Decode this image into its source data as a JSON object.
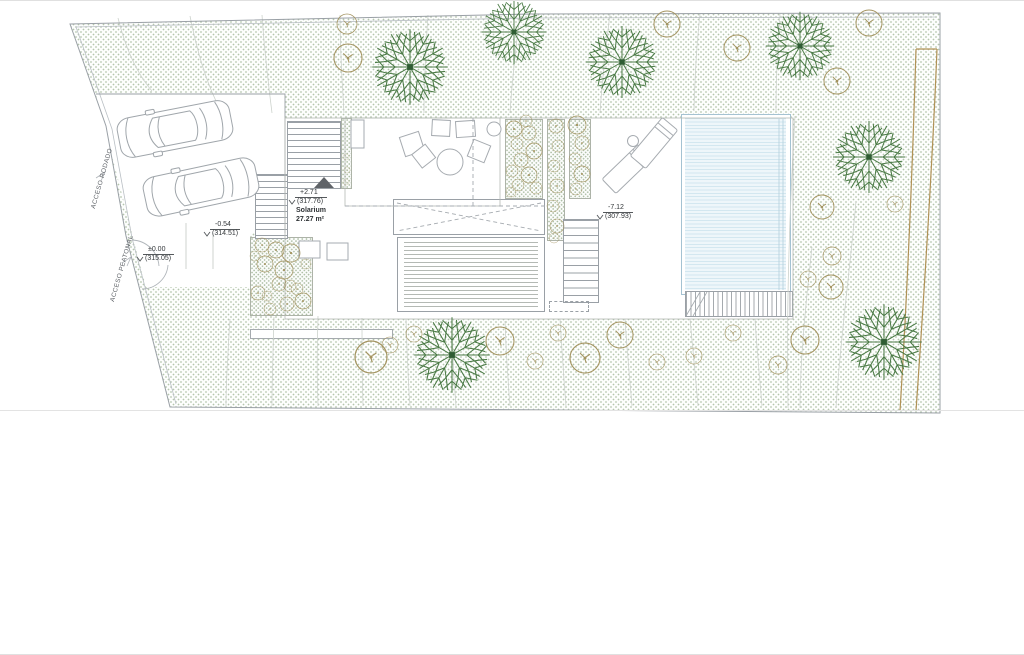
{
  "document": {
    "type": "architectural site plan",
    "view": "top view landscaping / roof plan"
  },
  "labels": {
    "acceso_rodado": "ACCESO RODADO",
    "acceso_peatonal": "ACCESO PEATONAL",
    "solarium": {
      "name": "Solarium",
      "area": "27.27 m²"
    },
    "levels": {
      "terrace": {
        "value": "+2.71",
        "datum": "(317.76)"
      },
      "garage": {
        "value": "-0.54",
        "datum": "(314.51)"
      },
      "entry": {
        "value": "±0.00",
        "datum": "(315.05)"
      },
      "pool": {
        "value": "-7.12",
        "datum": "(307.93)"
      }
    }
  },
  "colors": {
    "ink": "#33373a",
    "line": "#9aa0a6",
    "line_light": "#c9cfc9",
    "green_tree": "#4a7a45",
    "green_dark": "#2f5d33",
    "tan": "#a3935f",
    "tan_path": "#b09155",
    "pool_fill": "#eef6fa",
    "pool_line": "#d3e7f0",
    "stipple_dot": "#7a966c"
  },
  "plan": {
    "green_trees": [
      {
        "x": 410,
        "y": 66,
        "s": 1.05
      },
      {
        "x": 514,
        "y": 31,
        "s": 0.9
      },
      {
        "x": 622,
        "y": 61,
        "s": 1.0
      },
      {
        "x": 800,
        "y": 45,
        "s": 0.95
      },
      {
        "x": 869,
        "y": 156,
        "s": 1.0
      },
      {
        "x": 884,
        "y": 341,
        "s": 1.05
      },
      {
        "x": 452,
        "y": 354,
        "s": 1.05
      }
    ],
    "circle_trees": [
      {
        "x": 347,
        "y": 23,
        "r": 10
      },
      {
        "x": 348,
        "y": 57,
        "r": 14
      },
      {
        "x": 667,
        "y": 23,
        "r": 13
      },
      {
        "x": 737,
        "y": 47,
        "r": 13
      },
      {
        "x": 869,
        "y": 22,
        "r": 13
      },
      {
        "x": 837,
        "y": 80,
        "r": 13
      },
      {
        "x": 822,
        "y": 206,
        "r": 12
      },
      {
        "x": 895,
        "y": 203,
        "r": 8
      },
      {
        "x": 832,
        "y": 255,
        "r": 9
      },
      {
        "x": 808,
        "y": 278,
        "r": 8
      },
      {
        "x": 831,
        "y": 286,
        "r": 12
      },
      {
        "x": 805,
        "y": 339,
        "r": 14
      },
      {
        "x": 778,
        "y": 364,
        "r": 9
      },
      {
        "x": 371,
        "y": 356,
        "r": 16
      },
      {
        "x": 390,
        "y": 344,
        "r": 8
      },
      {
        "x": 414,
        "y": 333,
        "r": 8
      },
      {
        "x": 500,
        "y": 340,
        "r": 14
      },
      {
        "x": 535,
        "y": 360,
        "r": 8
      },
      {
        "x": 558,
        "y": 332,
        "r": 8
      },
      {
        "x": 585,
        "y": 357,
        "r": 15
      },
      {
        "x": 620,
        "y": 334,
        "r": 13
      },
      {
        "x": 657,
        "y": 361,
        "r": 8
      },
      {
        "x": 694,
        "y": 355,
        "r": 8
      },
      {
        "x": 733,
        "y": 332,
        "r": 8
      }
    ],
    "bushes": [
      {
        "x": 262,
        "y": 244,
        "r": 7
      },
      {
        "x": 276,
        "y": 249,
        "r": 8
      },
      {
        "x": 291,
        "y": 252,
        "r": 9
      },
      {
        "x": 265,
        "y": 263,
        "r": 8
      },
      {
        "x": 284,
        "y": 269,
        "r": 9
      },
      {
        "x": 279,
        "y": 283,
        "r": 7
      },
      {
        "x": 290,
        "y": 285,
        "r": 6
      },
      {
        "x": 258,
        "y": 292,
        "r": 7
      },
      {
        "x": 267,
        "y": 295,
        "r": 5
      },
      {
        "x": 270,
        "y": 308,
        "r": 6
      },
      {
        "x": 287,
        "y": 303,
        "r": 7
      },
      {
        "x": 303,
        "y": 300,
        "r": 8
      },
      {
        "x": 297,
        "y": 288,
        "r": 6
      },
      {
        "x": 306,
        "y": 263,
        "r": 5
      },
      {
        "x": 255,
        "y": 255,
        "r": 5
      },
      {
        "x": 514,
        "y": 128,
        "r": 8
      },
      {
        "x": 529,
        "y": 132,
        "r": 7
      },
      {
        "x": 517,
        "y": 143,
        "r": 6
      },
      {
        "x": 534,
        "y": 150,
        "r": 8
      },
      {
        "x": 521,
        "y": 159,
        "r": 7
      },
      {
        "x": 512,
        "y": 170,
        "r": 6
      },
      {
        "x": 529,
        "y": 174,
        "r": 8
      },
      {
        "x": 518,
        "y": 184,
        "r": 6
      },
      {
        "x": 511,
        "y": 191,
        "r": 5
      },
      {
        "x": 536,
        "y": 187,
        "r": 6
      },
      {
        "x": 526,
        "y": 120,
        "r": 6
      },
      {
        "x": 556,
        "y": 125,
        "r": 7
      },
      {
        "x": 558,
        "y": 145,
        "r": 6
      },
      {
        "x": 554,
        "y": 165,
        "r": 6
      },
      {
        "x": 557,
        "y": 185,
        "r": 7
      },
      {
        "x": 553,
        "y": 205,
        "r": 6
      },
      {
        "x": 557,
        "y": 225,
        "r": 7
      },
      {
        "x": 554,
        "y": 237,
        "r": 5
      },
      {
        "x": 577,
        "y": 124,
        "r": 9
      },
      {
        "x": 582,
        "y": 142,
        "r": 7
      },
      {
        "x": 575,
        "y": 158,
        "r": 6
      },
      {
        "x": 582,
        "y": 173,
        "r": 8
      },
      {
        "x": 576,
        "y": 188,
        "r": 6
      },
      {
        "x": 346,
        "y": 156,
        "r": 3
      },
      {
        "x": 347,
        "y": 169,
        "r": 3
      },
      {
        "x": 346,
        "y": 181,
        "r": 3
      }
    ],
    "cars": [
      {
        "x": 175,
        "y": 128,
        "rot": -11
      },
      {
        "x": 201,
        "y": 186,
        "rot": -12
      }
    ],
    "loungers": [
      {
        "x": 627,
        "y": 168,
        "rot": 46
      },
      {
        "x": 654,
        "y": 142,
        "rot": 40
      }
    ],
    "contours": [
      "M118,17 C125,45 135,70 152,90",
      "M190,15 C196,45 204,75 216,100",
      "M262,14 C264,45 268,80 272,112",
      "M340,14 C340,45 342,80 344,112",
      "M428,14 C426,45 424,80 424,112",
      "M520,13 C516,45 512,80 510,112",
      "M610,13 C606,45 602,80 600,112",
      "M700,13 C697,40 695,70 694,110",
      "M780,13 C778,40 776,70 776,110",
      "M795,115 C790,200 786,300 788,407",
      "M856,200 C850,270 840,340 836,407",
      "M812,246 C806,300 800,360 800,407",
      "M230,318 C228,350 226,380 226,405",
      "M274,316 C273,350 272,380 272,405",
      "M318,315 C317,350 317,380 318,405",
      "M362,317 C362,350 362,380 363,405",
      "M406,318 C407,350 408,380 410,405",
      "M452,320 C452,350 454,380 456,405",
      "M505,320 C506,350 508,380 510,405",
      "M560,318 C562,350 564,380 566,405",
      "M625,318 C627,350 630,380 632,405",
      "M690,318 C693,350 696,380 698,405",
      "M755,318 C757,350 760,380 762,405"
    ],
    "tan_paths": [
      "M916,48 L937,48",
      "M916,48 C913,150 908,280 900,410",
      "M937,48 C933,150 925,280 916,410"
    ]
  }
}
